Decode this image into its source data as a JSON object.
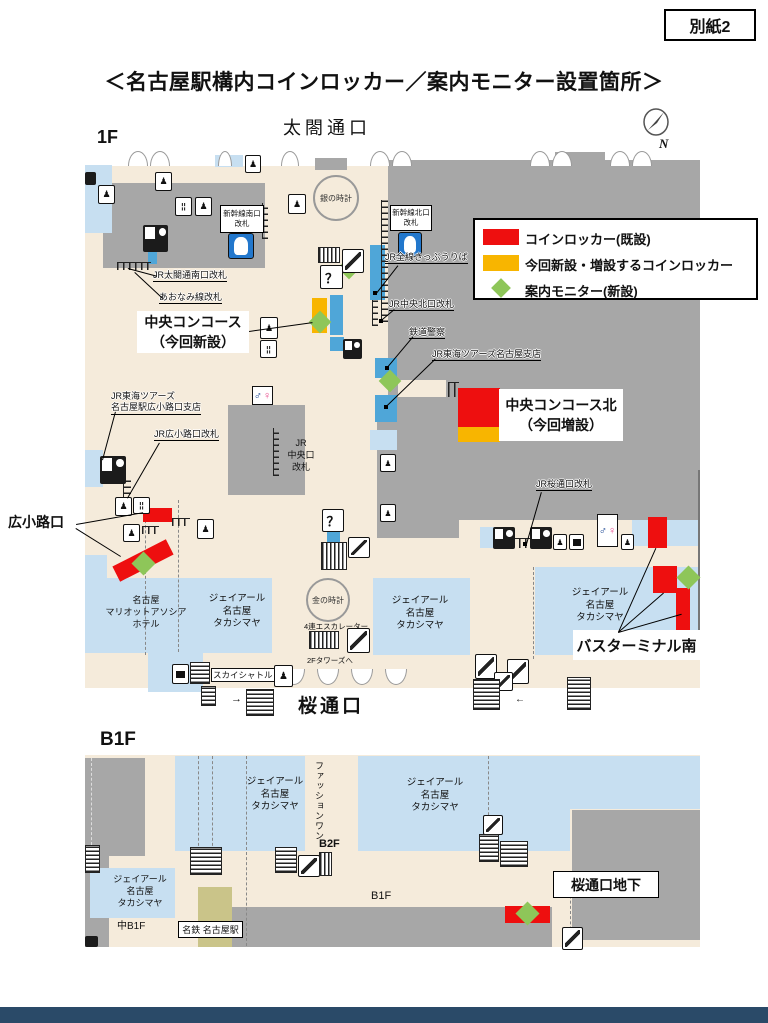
{
  "page": {
    "attachment": "別紙2",
    "title": "＜名古屋駅構内コインロッカー／案内モニター設置箇所＞"
  },
  "colors": {
    "locker_existing": "#ee0f0f",
    "locker_new": "#f8b500",
    "monitor": "#8ec659",
    "floor": "#f5ebdb",
    "structure": "#a7a7a7",
    "store_blue": "#c7dff1",
    "platform_blue": "#4fa6d8",
    "meitetsu_khaki": "#cac489",
    "footer_navy": "#2a4a68"
  },
  "legend": {
    "existing": "コインロッカー(既設)",
    "new": "今回新設・増設するコインロッカー",
    "monitor": "案内モニター(新設)"
  },
  "floor1": {
    "name": "1F",
    "taiko_exit": "太閤通口",
    "sakuradori_exit": "桜通口",
    "hirokoji_exit": "広小路口",
    "compass_n": "N",
    "clocks": {
      "silver": "銀の時計",
      "gold": "金の時計"
    },
    "gates": {
      "shinkansen_south": "新幹線南口改札",
      "shinkansen_north": "新幹線北口改札",
      "taiko_south": "JR太閤通南口改札",
      "aonami": "あおなみ線改札",
      "central_north": "JR中央北口改札",
      "central": [
        "JR",
        "中央口",
        "改札"
      ],
      "hirokoji": "JR広小路口改札",
      "sakuradori": "JR桜通口改札"
    },
    "places": {
      "tickets": "JR全線きっぷうりば",
      "police": "鉄道警察",
      "tours": "JR東海ツアーズ名古屋支店",
      "tours_hirokoji": [
        "JR東海ツアーズ",
        "名古屋駅広小路口支店"
      ],
      "sky_shuttle": "スカイシャトル",
      "four_escalators": "4連エスカレーター",
      "to_towers": "2Fタワーズへ",
      "marriott": [
        "名古屋",
        "マリオットアソシア",
        "ホテル"
      ],
      "takashimaya": [
        "ジェイアール",
        "名古屋",
        "タカシマヤ"
      ]
    },
    "notes": {
      "central_concourse_1": "中央コンコース",
      "central_concourse_2": "（今回新設）",
      "central_north_1": "中央コンコース北",
      "central_north_2": "（今回増設）",
      "bus_terminal": "バスターミナル南"
    }
  },
  "floorB1": {
    "name": "B1F",
    "fashion_one": "ファッションワン",
    "b2f": "B2F",
    "b1f": "B1F",
    "naka_b1f": "中B1F",
    "meitetsu": "名鉄 名古屋駅",
    "sakura_underground": "桜通口地下"
  },
  "icons": {
    "info": "？",
    "person": "♟",
    "male": "♂",
    "female": "♀",
    "fork": "¦¦",
    "arrow_right": "→",
    "arrow_left": "←"
  }
}
